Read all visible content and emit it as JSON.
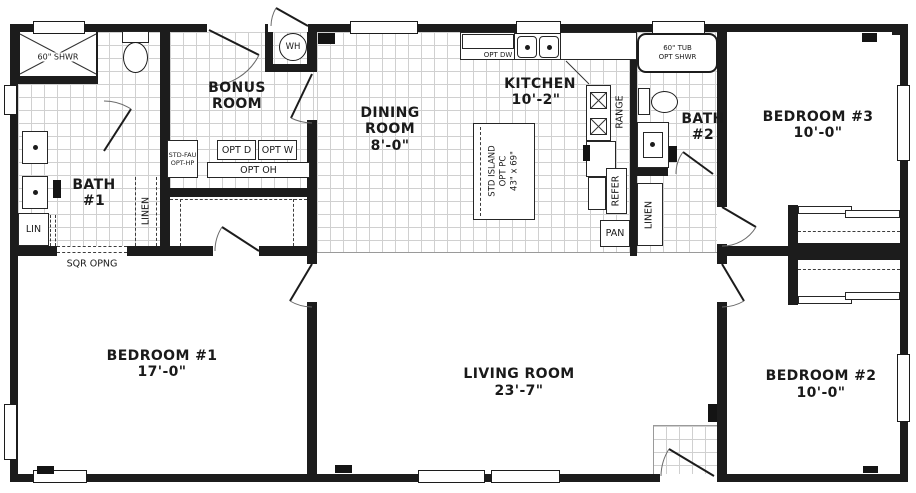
{
  "colors": {
    "wall": "#1c1c1c",
    "tile_line": "#d0d0d0"
  },
  "rooms": {
    "bonus_room": {
      "line1": "BONUS",
      "line2": "ROOM"
    },
    "dining_room": {
      "line1": "DINING",
      "line2": "ROOM",
      "dim": "8'-0\""
    },
    "kitchen": {
      "line1": "KITCHEN",
      "dim": "10'-2\""
    },
    "bath_1": {
      "line1": "BATH",
      "line2": "#1"
    },
    "bath_2": {
      "line1": "BATH",
      "line2": "#2"
    },
    "bedroom_1": {
      "line1": "BEDROOM #1",
      "dim": "17'-0\""
    },
    "bedroom_2": {
      "line1": "BEDROOM #2",
      "dim": "10'-0\""
    },
    "bedroom_3": {
      "line1": "BEDROOM #3",
      "dim": "10'-0\""
    },
    "living_room": {
      "line1": "LIVING ROOM",
      "dim": "23'-7\""
    }
  },
  "fixtures": {
    "shower": "60\" SHWR",
    "tub_line1": "60\" TUB",
    "tub_line2": "OPT SHWR",
    "water_heater": "WH",
    "opt_dishwasher": "OPT DW",
    "opt_dryer": "OPT D",
    "opt_washer": "OPT W",
    "opt_overhead": "OPT OH",
    "furnace_line1": "STD-FAU",
    "furnace_line2": "OPT-HP",
    "linen_small": "LIN",
    "linen_bath1": "LINEN",
    "linen_hall": "LINEN",
    "range": "RANGE",
    "refrigerator": "REFER",
    "pantry": "PAN",
    "island_line1": "STD ISLAND",
    "island_line2": "OPT PC",
    "island_line3": "43\" x 69\"",
    "square_opening": "SQR OPNG"
  }
}
